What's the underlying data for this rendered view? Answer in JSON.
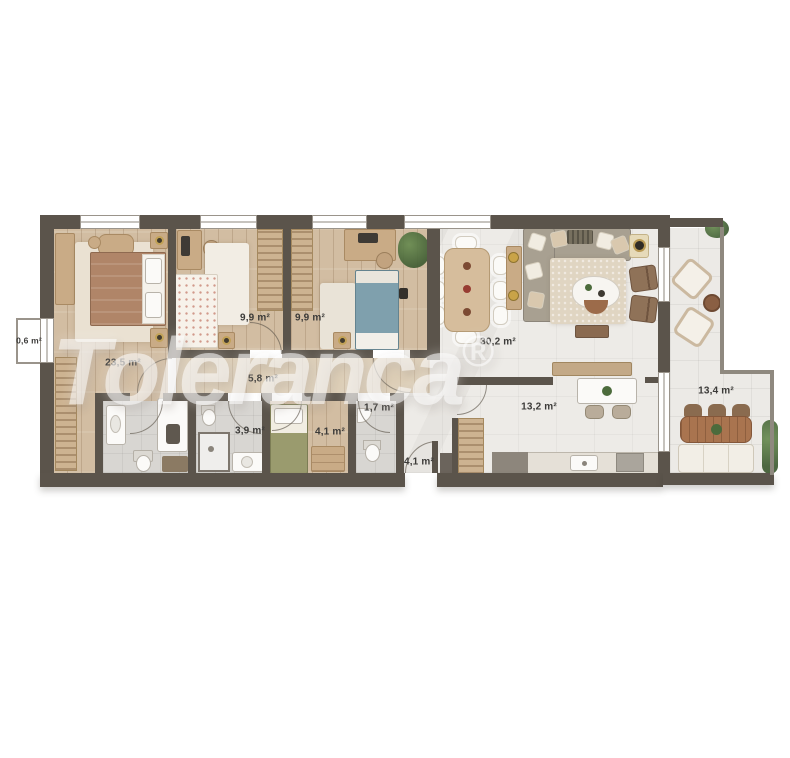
{
  "watermark": {
    "text": "Toleranca",
    "registered_mark": "®"
  },
  "rooms": {
    "shaft": {
      "label": "0,6 m²"
    },
    "bedroom1": {
      "label": "23,5 m²"
    },
    "bedroom2": {
      "label": "9,9 m²"
    },
    "bedroom3": {
      "label": "9,9 m²"
    },
    "hallway": {
      "label": "5,8 m²"
    },
    "bathroom": {
      "label": "3,9 m²"
    },
    "study": {
      "label": "4,1 m²"
    },
    "wc": {
      "label": "1,7 m²"
    },
    "entrance_hall": {
      "label": "4,1 m²"
    },
    "living_dining": {
      "label": "30,2 m²"
    },
    "kitchen": {
      "label": "13,2 m²"
    },
    "terrace": {
      "label": "13,4 m²"
    }
  },
  "colors": {
    "wall": "#5b544b",
    "wood_floor": "#d2bda2",
    "corridor_floor": "#dccdb5",
    "marble_floor": "#edebe7",
    "bath_floor": "#d8d6d2",
    "bed_blanket_brown": "#b08568",
    "bed_blue": "#7fa0ad",
    "bed_green": "#9a9b6e",
    "watermark": "rgba(255,255,255,0.55)"
  }
}
